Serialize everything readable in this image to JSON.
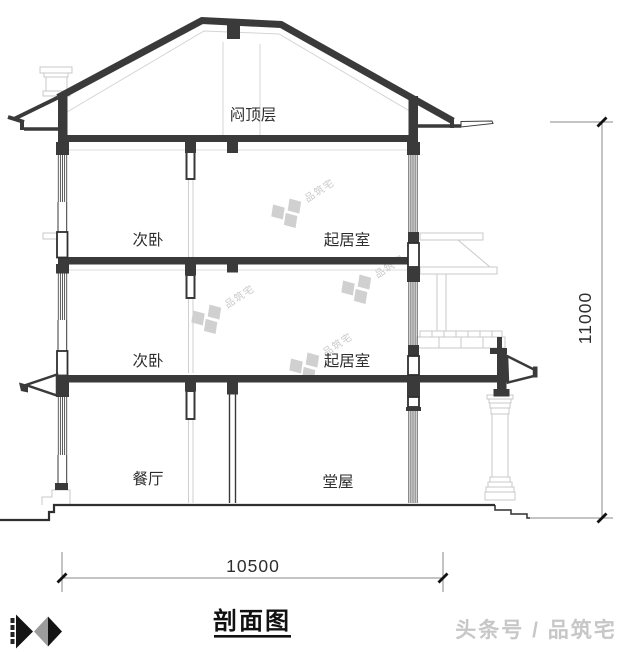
{
  "section": {
    "title": "剖面图",
    "rooms": [
      {
        "name": "attic",
        "label": "闷顶层"
      },
      {
        "name": "bedroom-3f",
        "label": "次卧"
      },
      {
        "name": "living-3f",
        "label": "起居室"
      },
      {
        "name": "bedroom-2f",
        "label": "次卧"
      },
      {
        "name": "living-2f",
        "label": "起居室"
      },
      {
        "name": "dining-1f",
        "label": "餐厅"
      },
      {
        "name": "hall-1f",
        "label": "堂屋"
      }
    ],
    "dimensions": {
      "width_mm": "10500",
      "height_mm": "11000"
    }
  },
  "watermark": {
    "brand": "品筑宅"
  },
  "footer": {
    "credit": "头条号 / 品筑宅"
  },
  "palette": {
    "section_dark": "#3a3a3a",
    "line_gray": "#c9c9c9",
    "text_dark": "#2e2e2e",
    "logo_gray": "#9c9c9c",
    "logo_black": "#141414"
  }
}
